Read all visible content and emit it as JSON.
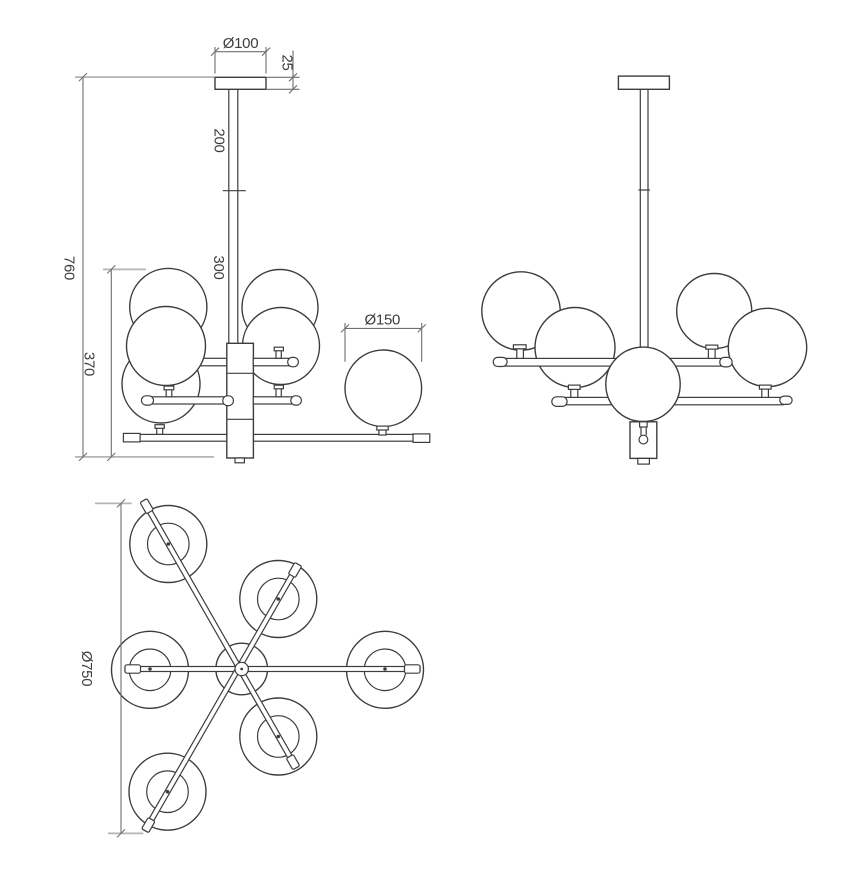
{
  "drawing": {
    "type": "technical-drawing",
    "subject": "6-globe chandelier dimensional drawing, three views",
    "colors": {
      "line": "#3d3d3d",
      "dim": "#6f6f6f",
      "ext": "#b4b4b4",
      "text": "#3d3d3d",
      "background": "#ffffff"
    },
    "dimensions": {
      "canopy_diameter": "Ø100",
      "canopy_height": "25",
      "upper_rod_length": "200",
      "lower_rod_length": "300",
      "overall_height": "760",
      "body_height": "370",
      "globe_diameter": "Ø150",
      "overall_diameter": "Ø750"
    }
  }
}
